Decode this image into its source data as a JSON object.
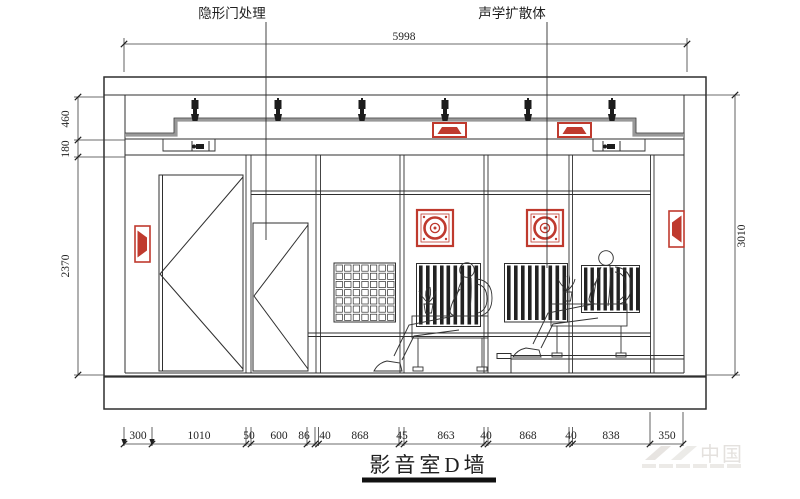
{
  "drawing_title": {
    "text": "影音室D墙"
  },
  "callouts": {
    "hidden_door": "隐形门处理",
    "acoustic_diffuser": "声学扩散体"
  },
  "dimensions": {
    "overall_width": "5998",
    "overall_height": "3010",
    "left": [
      "460",
      "180",
      "2370"
    ],
    "bottom": [
      "300",
      "1010",
      "50",
      "600",
      "86",
      "40",
      "868",
      "45",
      "863",
      "40",
      "868",
      "40",
      "838",
      "350"
    ]
  },
  "watermark": {
    "text": "中国"
  },
  "colors": {
    "line": "#2f2f2f",
    "accent_red": "#bf3a2e",
    "ceiling_gray": "#999999",
    "watermark_gray": "#e4e1de"
  }
}
